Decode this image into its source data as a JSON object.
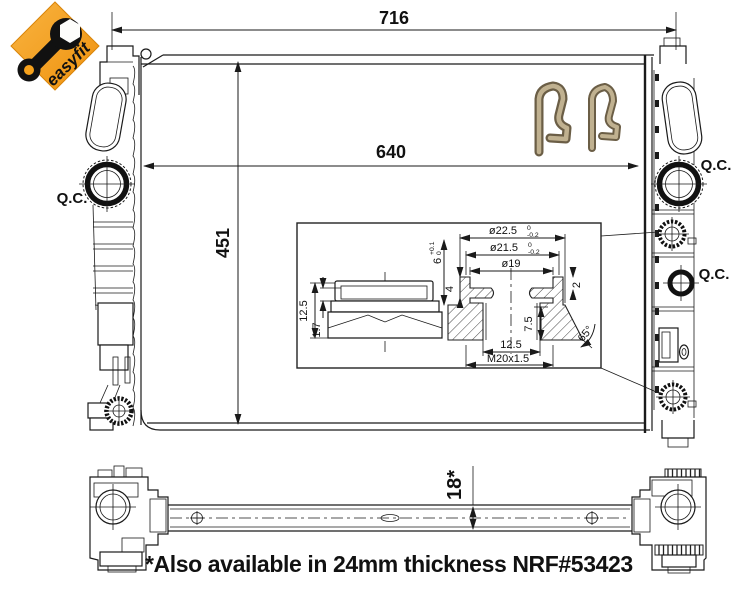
{
  "logo": {
    "brand": "easyfit",
    "badge_color": "#f5a11c",
    "wrench_color": "#111111"
  },
  "front_view": {
    "dim_overall_width": "716",
    "dim_core_width": "640",
    "dim_core_height": "451",
    "qc_left": "Q.C.",
    "qc_right_upper": "Q.C.",
    "qc_right_lower": "Q.C."
  },
  "detail_inset": {
    "dia_outer": "ø22.5",
    "dia_outer_tol_top": "0",
    "dia_outer_tol_bot": "-0.2",
    "dia_mid": "ø21.5",
    "dia_mid_tol_top": "0",
    "dia_mid_tol_bot": "-0.2",
    "dia_inner": "ø19",
    "seat_depth": "6",
    "seat_depth_tol_top": "+0.1",
    "seat_depth_tol_bot": "0",
    "groove_top": "4",
    "groove_lip": "2",
    "bore_depth": "7.5",
    "bore_width": "12.5",
    "thread": "M20x1.5",
    "chamfer_angle": "65°",
    "plug_height": "12.5",
    "plug_lip": "1.7"
  },
  "side_view": {
    "dim_thickness": "18*"
  },
  "footnote": "*Also available in 24mm thickness NRF#53423"
}
